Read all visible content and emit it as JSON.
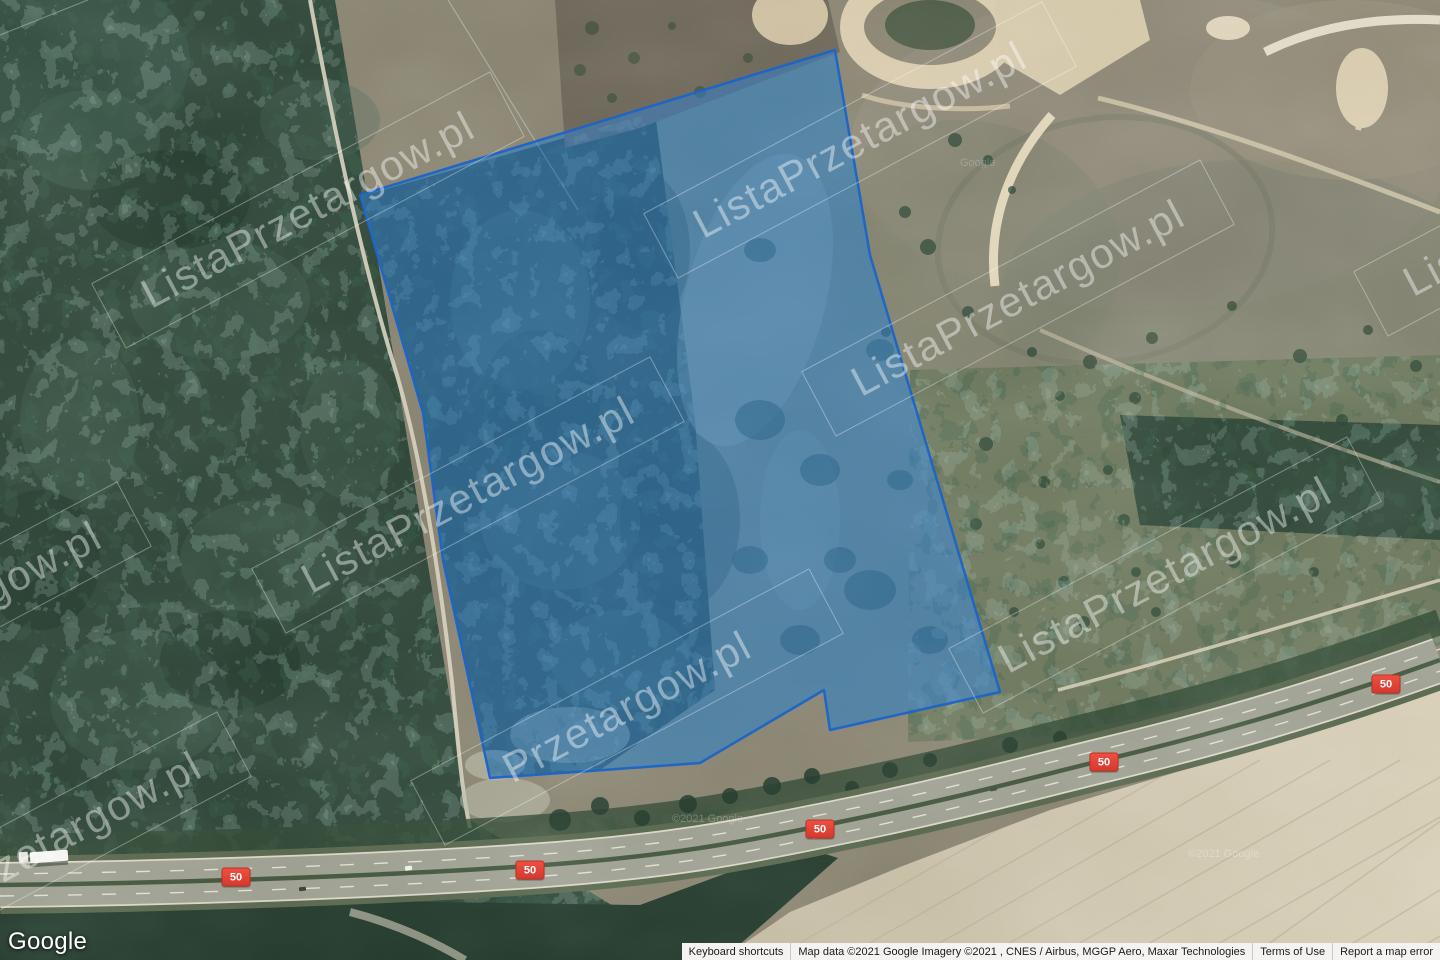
{
  "map": {
    "description": "Google satellite map with highlighted auction parcel",
    "parcel": {
      "points": "360,195 835,50 870,255 1000,692 830,730 824,690 700,763 590,771 490,778 443,560 423,413",
      "fill": "#2e7fd6",
      "fill_opacity": 0.5,
      "stroke": "#1b64c8"
    },
    "route_shield": {
      "label": "50",
      "color": "#e2453b",
      "positions": [
        {
          "x": 236,
          "y": 877
        },
        {
          "x": 530,
          "y": 870
        },
        {
          "x": 820,
          "y": 829
        },
        {
          "x": 1104,
          "y": 762
        },
        {
          "x": 1386,
          "y": 684
        }
      ]
    },
    "watermarks": [
      {
        "text": "ListaPrzetargow.pl",
        "x": 308,
        "y": 210,
        "angle": -28
      },
      {
        "text": "ListaPrzetargow.pl",
        "x": 860,
        "y": 140,
        "angle": -28
      },
      {
        "text": "ListaPrzetargow.pl",
        "x": 1018,
        "y": 298,
        "angle": -28
      },
      {
        "text": "ListaPrzetargow.pl",
        "x": 468,
        "y": 495,
        "angle": -28
      },
      {
        "text": "ListaPrzetargow.pl",
        "x": 1165,
        "y": 575,
        "angle": -28
      },
      {
        "text": "Przetargow.pl",
        "x": 627,
        "y": 707,
        "angle": -28
      },
      {
        "text": "ListaPrzetargow.pl",
        "x": -65,
        "y": 620,
        "angle": -28
      },
      {
        "text": "ListaPrzetargow.pl",
        "x": 35,
        "y": 850,
        "angle": -28
      },
      {
        "text": "ListaPrzetargow.pl",
        "x": 1570,
        "y": 198,
        "angle": -28
      }
    ],
    "imagery_credits": [
      {
        "text": "Google",
        "x": 960,
        "y": 166,
        "opacity": 0.2
      },
      {
        "text": "©2021 Google",
        "x": 672,
        "y": 822,
        "opacity": 0.25
      },
      {
        "text": "©2021 Google",
        "x": 1188,
        "y": 857,
        "opacity": 0.28
      }
    ]
  },
  "google_logo": "Google",
  "attribution": {
    "keyboard_shortcuts": "Keyboard shortcuts",
    "map_data": "Map data ©2021 Google Imagery ©2021 , CNES / Airbus, MGGP Aero, Maxar Technologies",
    "terms": "Terms of Use",
    "report_error": "Report a map error"
  }
}
